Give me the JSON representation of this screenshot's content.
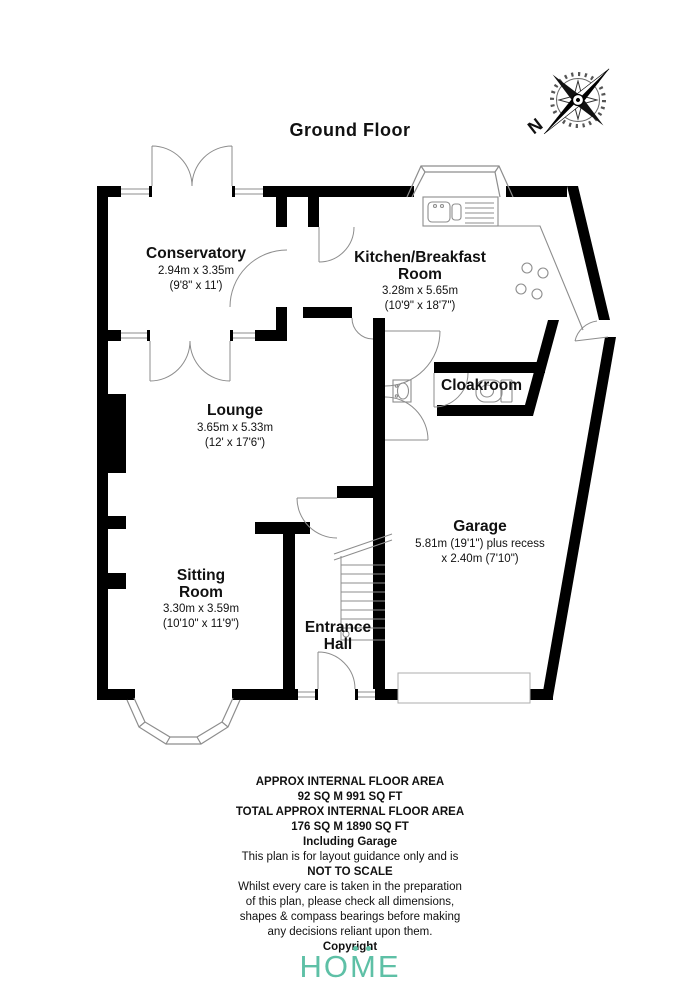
{
  "page": {
    "title": "Ground Floor",
    "background": "#ffffff"
  },
  "compass": {
    "north_label": "N"
  },
  "rooms": {
    "conservatory": {
      "name": "Conservatory",
      "metric": "2.94m x 3.35m",
      "imperial": "(9'8\" x 11')"
    },
    "kitchen": {
      "name": "Kitchen/Breakfast Room",
      "metric": "3.28m x 5.65m",
      "imperial": "(10'9\" x 18'7\")"
    },
    "cloakroom": {
      "name": "Cloakroom"
    },
    "lounge": {
      "name": "Lounge",
      "metric": "3.65m x 5.33m",
      "imperial": "(12' x 17'6\")"
    },
    "garage": {
      "name": "Garage",
      "metric": "5.81m (19'1\") plus recess",
      "imperial": "x 2.40m (7'10\")"
    },
    "sitting_room": {
      "name": "Sitting Room",
      "metric": "3.30m x 3.59m",
      "imperial": "(10'10\" x 11'9\")"
    },
    "entrance_hall": {
      "name": "Entrance Hall"
    }
  },
  "footer": {
    "lines": [
      "APPROX INTERNAL FLOOR AREA",
      "92 SQ M 991 SQ FT",
      "TOTAL APPROX INTERNAL FLOOR AREA",
      "176 SQ M 1890 SQ FT",
      "Including Garage",
      "This plan is for layout guidance only and is",
      "NOT TO SCALE",
      "Whilst every care is taken in the preparation",
      "of this plan, please check all dimensions,",
      "shapes & compass bearings before making",
      "any decisions reliant upon them.",
      "Copyright"
    ]
  },
  "logo": {
    "text": "HOME",
    "color": "#5ec0a6"
  },
  "colors": {
    "walls": "#000000",
    "fixtures": "#8d8d8d",
    "text": "#111111",
    "logo_accent": "#5ec0a6"
  }
}
